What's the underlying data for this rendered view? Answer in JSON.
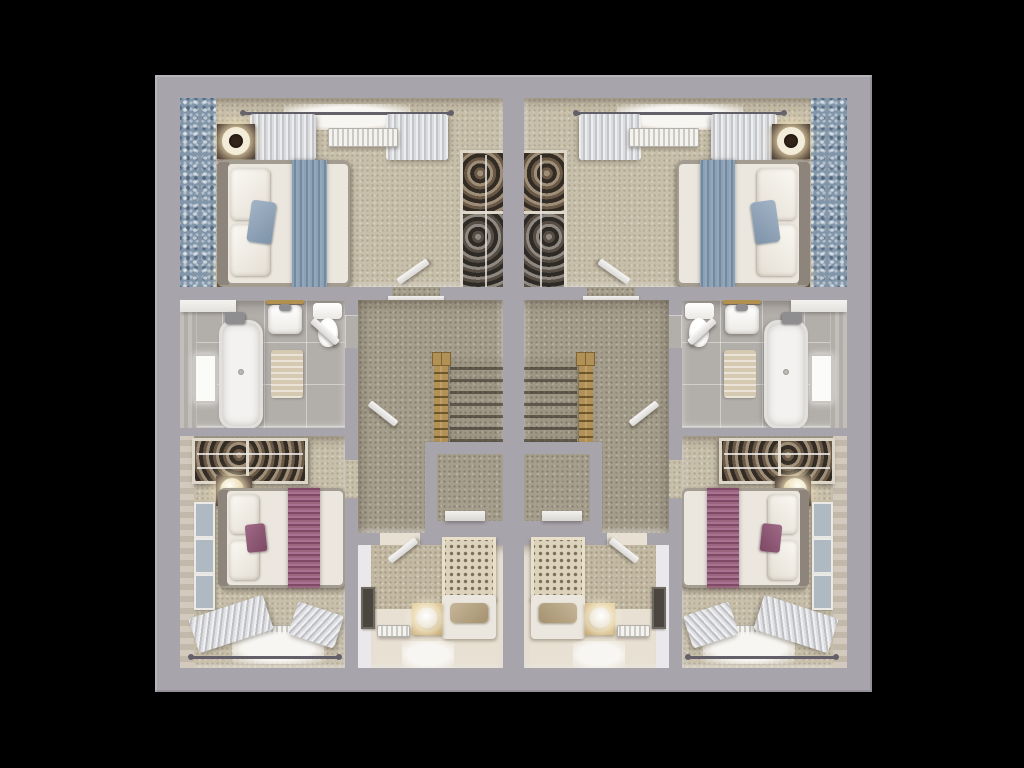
{
  "scene": {
    "type": "3d-floor-plan-top-view",
    "description": "Dollhouse aerial render of two mirrored semi-detached house upper floors on a black background",
    "units": [
      {
        "id": "unit-left",
        "mirrored": false
      },
      {
        "id": "unit-right",
        "mirrored": true
      }
    ],
    "rooms": [
      {
        "name": "master-bedroom",
        "furniture": [
          "double-bed",
          "blue-throw-runner",
          "blue-cushion",
          "nightstands",
          "ring-lamps",
          "curtained-window",
          "radiator",
          "open-wardrobe",
          "blue-pattern-accent-wall"
        ]
      },
      {
        "name": "bathroom",
        "furniture": [
          "bathtub",
          "basin",
          "toilet",
          "bath-mat",
          "brass-towel-rail",
          "window",
          "vanity-counter"
        ]
      },
      {
        "name": "landing",
        "furniture": [
          "staircase",
          "wood-banister",
          "airing-cupboard",
          "doors"
        ]
      },
      {
        "name": "bedroom-two",
        "furniture": [
          "double-bed",
          "plum-throw-runner",
          "plum-cushion",
          "open-wardrobe",
          "nightstands",
          "globe-lamps",
          "three-picture-frames",
          "curtained-window",
          "radiator"
        ]
      },
      {
        "name": "bedroom-three",
        "furniture": [
          "single-bed-waffle-quilt",
          "taupe-pillow",
          "cube-nightstand",
          "disc-lamp",
          "radiator",
          "picture-frame",
          "window"
        ]
      }
    ]
  },
  "colors": {
    "bg": "#000000",
    "wall": "#a8a4ac",
    "wall-face": "#eae8ea",
    "carpet-bedroom": "#c8bfaa",
    "carpet-landing": "#a69e8c",
    "blue-accent": "#8296a9",
    "duvet": "#ebe7de",
    "bed-base": "#a39c90",
    "headboard": "#8d857b",
    "nightstand": "#40302a",
    "closet-frame": "#ddd7ca",
    "closet-dark": "#3a342e",
    "tile": "#b2aeaa",
    "tub": "#f3f2f0",
    "mat": "#d6c9b1",
    "brass": "#b2904f",
    "cream-floor": "#e8e0d2",
    "small-accent": "#c3b9a2",
    "quilt": "#ddd3bc",
    "window-glow": "#f8f6f2",
    "rail": "#63606a",
    "stair-wood": "#b19156"
  }
}
